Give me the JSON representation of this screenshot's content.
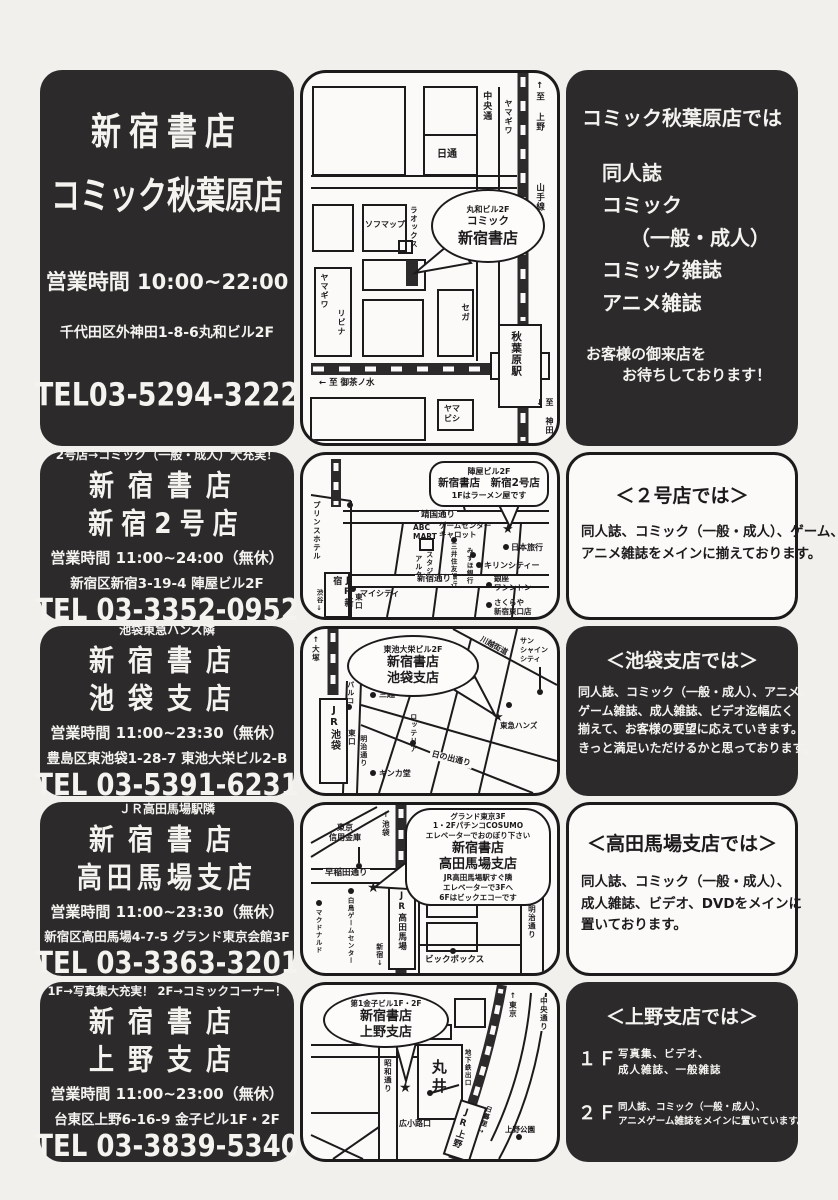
{
  "page": {
    "bg": "#f2f0ec",
    "ink": "#1c1a1b",
    "panel_dark": "#2c2a2b",
    "panel_light": "#fbfaf8",
    "star": "★"
  },
  "stores": [
    {
      "id": "akihabara",
      "info": {
        "name1": "新宿書店",
        "name2": "コミック秋葉原店",
        "hours": "営業時間  10:00~22:00",
        "address": "千代田区外神田1-8-6丸和ビル2F",
        "tel": "TEL03-5294-3222"
      },
      "map": {
        "bubble1": "丸和ビル2F",
        "bubble2": "コミック",
        "bubble3": "新宿書店",
        "labels": {
          "chuo_dori": "中央通",
          "yamagiwa_top": "ヤマギワ",
          "to_ueno": "↑至 上野",
          "yamanote": "山手線",
          "nittsu": "日通",
          "sofmap": "ソフマップ",
          "laox": "ラオックス",
          "yamagiwa": "ヤマギワ",
          "livina": "リビナ",
          "sega": "セガ",
          "station": "秋葉原駅",
          "to_ochanomizu": "← 至 御茶ノ水",
          "yamabishi": "ヤマ\nビシ",
          "to_kanda": "至 神田↓"
        }
      },
      "desc": {
        "title": "コミック秋葉原店では",
        "items": [
          "同人誌",
          "コミック",
          "（一般・成人）",
          "コミック雑誌",
          "アニメ雑誌"
        ],
        "footer1": "お客様の御来店を",
        "footer2": "お待ちしております！"
      }
    },
    {
      "id": "shinjuku2",
      "info": {
        "tagline": "2号店→コミック（一般・成人）大充実！",
        "name1": "新宿書店",
        "name2": "新宿2号店",
        "hours": "営業時間  11:00~24:00（無休）",
        "address": "新宿区新宿3-19-4  陣屋ビル2F",
        "tel": "TEL 03-3352-0952"
      },
      "map": {
        "bubble1": "陣屋ビル2F",
        "bubble2": "新宿書店　新宿2号店",
        "bubble3": "1Fはラーメン屋です",
        "labels": {
          "prince_hotel": "プリンスホテル",
          "jr_shinjuku": "JR新宿",
          "shibuya": "渋谷↓",
          "higashi_guchi": "東口",
          "my_city": "マイシティ",
          "yasukuni_dori": "靖国通り",
          "abc_mart": "ABC\nMART",
          "game_center": "ゲームセンター\nキャロット",
          "mitsui_sumitomo": "三井住友銀行",
          "studio": "スタジオ",
          "alta": "アルタ",
          "mizuho": "みずほ銀行",
          "shinjuku_dori": "新宿通り",
          "nihon_ryoko": "日本旅行",
          "kirin_city": "キリンシティー",
          "ginza_washington": "銀座\nワシントン",
          "sakuraya": "さくらや\n新宿東口店"
        }
      },
      "desc": {
        "title": "＜２号店では＞",
        "lines": [
          "同人誌、コミック（一般・成人）、ゲーム、",
          "アニメ雑誌をメインに揃えております。"
        ]
      }
    },
    {
      "id": "ikebukuro",
      "info": {
        "tagline": "池袋東急ハンズ隣",
        "name1": "新宿書店",
        "name2": "池袋支店",
        "hours": "営業時間  11:00~23:30（無休）",
        "address": "豊島区東池袋1-28-7  東池大栄ビル2-B",
        "tel": "TEL 03-5391-6231"
      },
      "map": {
        "bubble1": "東池大栄ビル2F",
        "bubble2": "新宿書店",
        "bubble3": "池袋支店",
        "labels": {
          "to_otsuka": "↑大塚",
          "jr_ikebukuro": "JR池袋",
          "parco": "パルコ",
          "higashi_guchi": "東口",
          "meiji_dori": "明治通り",
          "mitsukoshi": "三越",
          "lotteria": "ロッテリア",
          "kawagoe_kaido": "川越街道",
          "sunshine": "サン\nシャイン\nシティ",
          "tokyu_hands": "東急ハンズ",
          "hinode_dori": "日の出通り",
          "kinkado": "キンカ堂"
        }
      },
      "desc": {
        "title": "＜池袋支店では＞",
        "lines": [
          "同人誌、コミック（一般・成人）、アニメ、",
          "ゲーム雑誌、成人雑誌、ビデオ迄幅広く",
          "揃えて、お客様の要望に応えていきます。",
          "きっと満足いただけるかと思っております。"
        ]
      }
    },
    {
      "id": "takadanobaba",
      "info": {
        "tagline": "ＪＲ高田馬場駅隣",
        "name1": "新宿書店",
        "name2": "高田馬場支店",
        "hours": "営業時間  11:00~23:30（無休）",
        "address": "新宿区高田馬場4-7-5  グランド東京会館3F",
        "tel": "TEL 03-3363-3201"
      },
      "map": {
        "bubble_small1": "グランド東京3F",
        "bubble_small2": "1・2FパチンコCOSUMO",
        "bubble_small3": "エレベーターでおのぼり下さい",
        "bubble_name1": "新宿書店",
        "bubble_name2": "高田馬場支店",
        "bubble_small4": "JR高田馬場駅すぐ隣",
        "bubble_small5": "エレベーターで3Fへ",
        "bubble_small6": "6Fはビックエコーです",
        "labels": {
          "shinkin": "東京\n信用金庫",
          "to_ikebukuro": "↑池袋",
          "waseda_dori": "早稲田通り",
          "shiratori": "白鳥ゲームセンター",
          "mcdonalds": "マクドナルド",
          "jr_takadanobaba": "JR高田馬場",
          "to_shinjuku": "新宿↓",
          "big_box": "ビックボックス",
          "meiji_dori": "明治通り"
        }
      },
      "desc": {
        "title": "＜高田馬場支店では＞",
        "lines": [
          "同人誌、コミック（一般・成人）、",
          "成人雑誌、ビデオ、DVDをメインに",
          "置いております。"
        ]
      }
    },
    {
      "id": "ueno",
      "info": {
        "tagline": "1F→写真集大充実！ 2F→コミックコーナー！",
        "name1": "新宿書店",
        "name2": "上野支店",
        "hours": "営業時間  11:00~23:00（無休）",
        "address": "台東区上野6-16-9  金子ビル1F・2F",
        "tel": "TEL 03-3839-5340"
      },
      "map": {
        "bubble1": "第1金子ビル1F・2F",
        "bubble2": "新宿書店",
        "bubble3": "上野支店",
        "labels": {
          "showa_dori": "昭和通り",
          "marui": "丸井",
          "subway_exit": "地下鉄出口",
          "to_tokyo": "↑東京",
          "chuo_dori": "中央通り",
          "jr_ueno": "JR上野",
          "nippori": "日暮里→",
          "hirokoji_guchi": "広小路口",
          "ueno_park": "上野公園"
        }
      },
      "desc": {
        "title": "＜上野支店では＞",
        "floor1_label": "１Ｆ",
        "floor1_lines": [
          "写真集、ビデオ、",
          "成人雑誌、一般雑誌"
        ],
        "floor2_label": "２Ｆ",
        "floor2_lines": [
          "同人誌、コミック（一般・成人）、",
          "アニメゲーム雑誌をメインに置いています。"
        ]
      }
    }
  ]
}
